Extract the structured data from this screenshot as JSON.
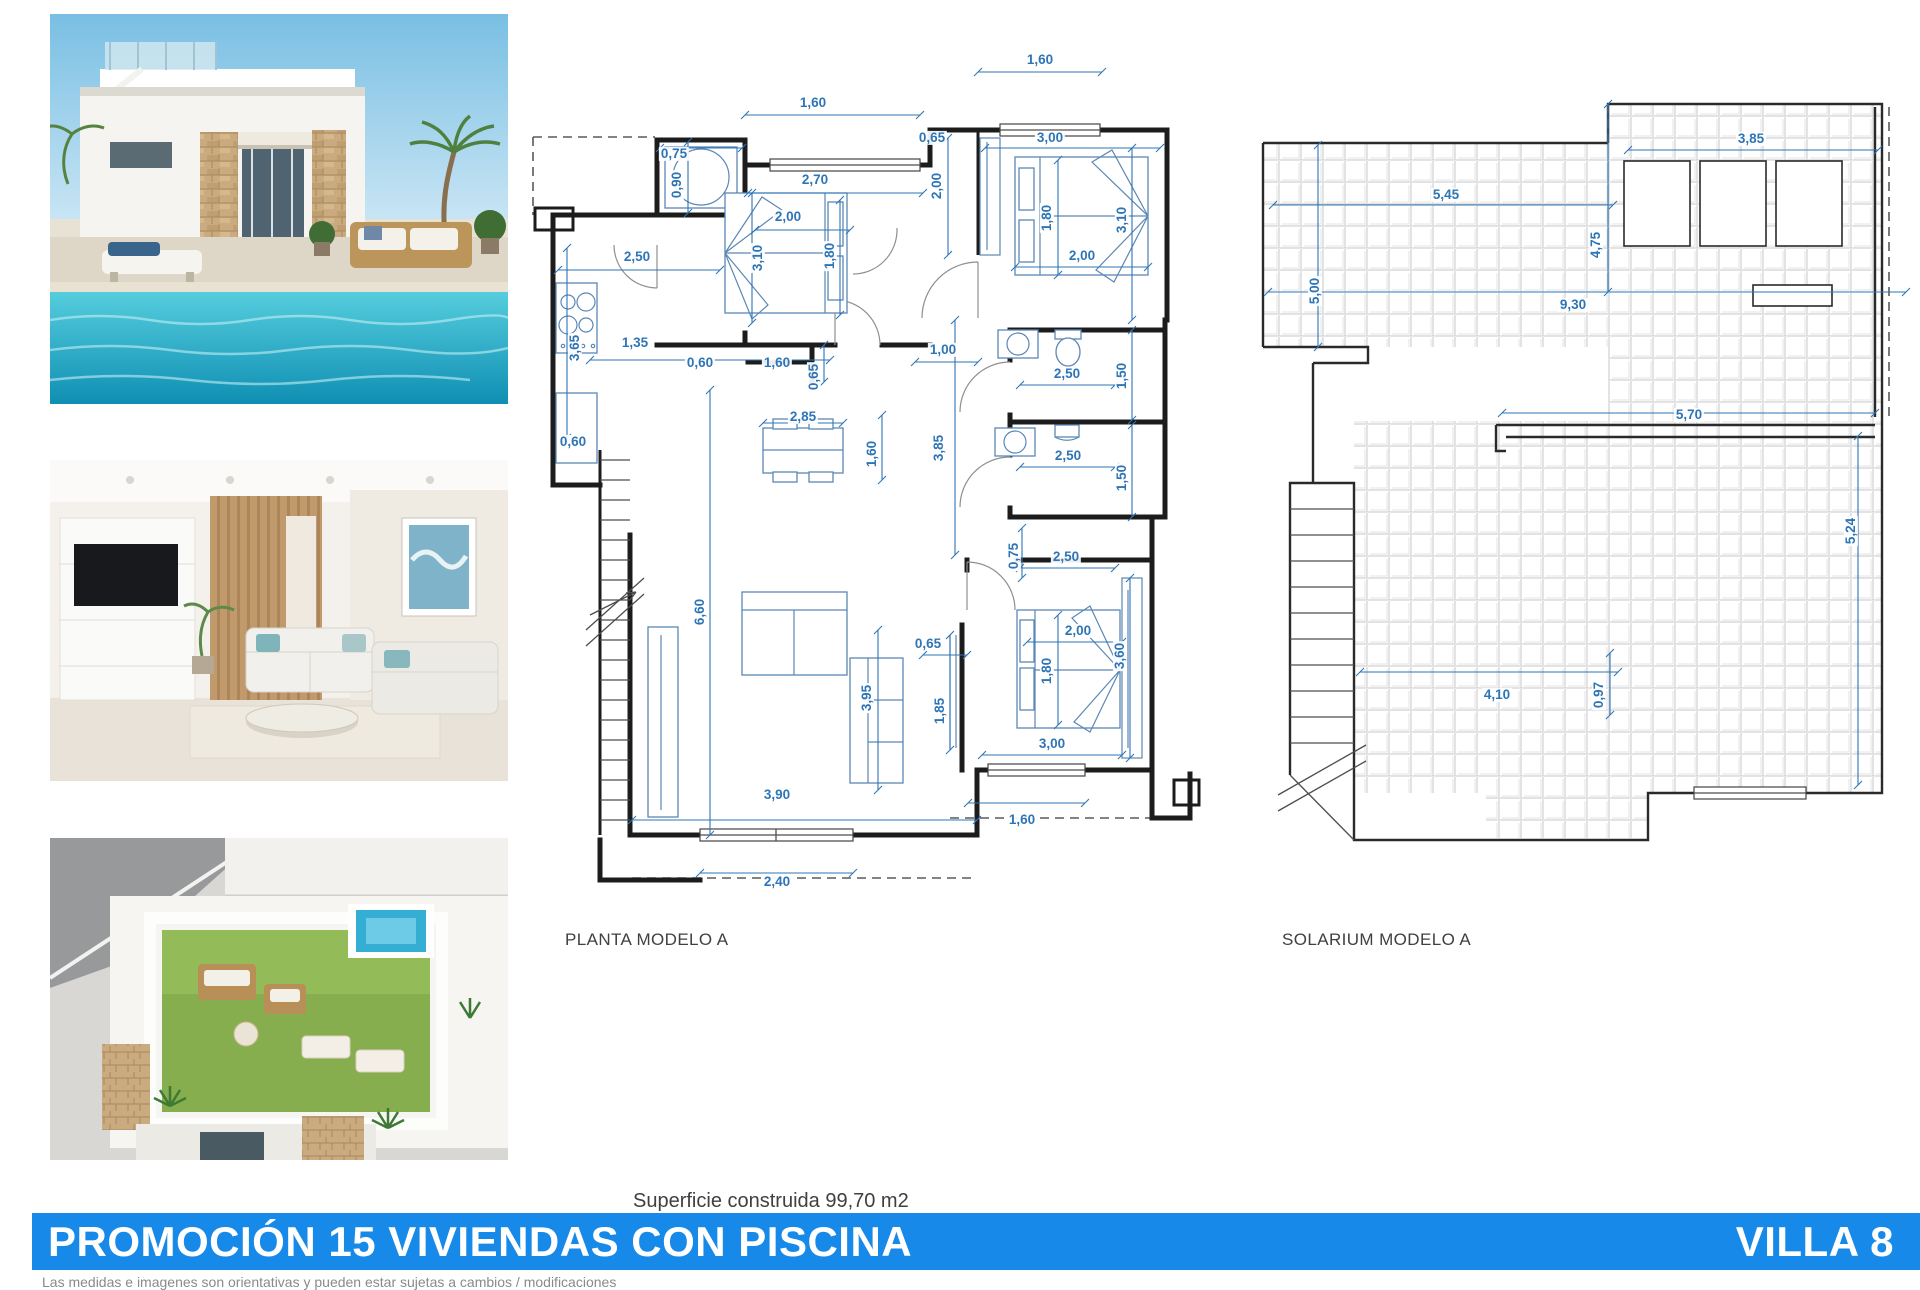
{
  "colors": {
    "dimension": "#2e75b6",
    "bar": "#1789e9",
    "wall": "#1c1c1c"
  },
  "planta": {
    "caption": "PLANTA MODELO A",
    "dims": [
      {
        "t": "1,60",
        "x": 283,
        "y": 73
      },
      {
        "t": "0,75",
        "x": 144,
        "y": 124
      },
      {
        "t": "0,90",
        "x": 147,
        "y": 155,
        "v": 1
      },
      {
        "t": "2,70",
        "x": 285,
        "y": 150
      },
      {
        "t": "2,00",
        "x": 258,
        "y": 187
      },
      {
        "t": "3,10",
        "x": 228,
        "y": 228,
        "v": 1
      },
      {
        "t": "1,80",
        "x": 300,
        "y": 226,
        "v": 1
      },
      {
        "t": "2,50",
        "x": 107,
        "y": 227
      },
      {
        "t": "3,65",
        "x": 45,
        "y": 318,
        "v": 1
      },
      {
        "t": "1,35",
        "x": 105,
        "y": 313
      },
      {
        "t": "0,60",
        "x": 170,
        "y": 333
      },
      {
        "t": "1,60",
        "x": 247,
        "y": 333
      },
      {
        "t": "0,65",
        "x": 284,
        "y": 347,
        "v": 1
      },
      {
        "t": "0,60",
        "x": 43,
        "y": 412
      },
      {
        "t": "1,60",
        "x": 510,
        "y": 30
      },
      {
        "t": "0,65",
        "x": 402,
        "y": 108
      },
      {
        "t": "3,00",
        "x": 520,
        "y": 108
      },
      {
        "t": "2,00",
        "x": 407,
        "y": 156,
        "v": 1
      },
      {
        "t": "1,80",
        "x": 517,
        "y": 188,
        "v": 1
      },
      {
        "t": "3,10",
        "x": 592,
        "y": 190,
        "v": 1
      },
      {
        "t": "2,00",
        "x": 552,
        "y": 226
      },
      {
        "t": "1,00",
        "x": 413,
        "y": 320
      },
      {
        "t": "2,50",
        "x": 537,
        "y": 344
      },
      {
        "t": "1,50",
        "x": 592,
        "y": 346,
        "v": 1
      },
      {
        "t": "2,50",
        "x": 538,
        "y": 426
      },
      {
        "t": "1,50",
        "x": 592,
        "y": 448,
        "v": 1
      },
      {
        "t": "2,85",
        "x": 273,
        "y": 387
      },
      {
        "t": "1,60",
        "x": 342,
        "y": 424,
        "v": 1
      },
      {
        "t": "3,85",
        "x": 409,
        "y": 418,
        "v": 1
      },
      {
        "t": "0,75",
        "x": 484,
        "y": 526,
        "v": 1
      },
      {
        "t": "2,50",
        "x": 536,
        "y": 527
      },
      {
        "t": "6,60",
        "x": 170,
        "y": 582,
        "v": 1
      },
      {
        "t": "3,95",
        "x": 337,
        "y": 668,
        "v": 1
      },
      {
        "t": "0,65",
        "x": 398,
        "y": 614
      },
      {
        "t": "1,85",
        "x": 410,
        "y": 681,
        "v": 1
      },
      {
        "t": "2,00",
        "x": 548,
        "y": 601
      },
      {
        "t": "1,80",
        "x": 517,
        "y": 641,
        "v": 1
      },
      {
        "t": "3,60",
        "x": 590,
        "y": 626,
        "v": 1
      },
      {
        "t": "3,00",
        "x": 522,
        "y": 714
      },
      {
        "t": "1,60",
        "x": 492,
        "y": 790
      },
      {
        "t": "3,90",
        "x": 247,
        "y": 765
      },
      {
        "t": "2,40",
        "x": 247,
        "y": 852
      }
    ]
  },
  "solarium": {
    "caption": "SOLARIUM MODELO A",
    "dims": [
      {
        "t": "3,85",
        "x": 493,
        "y": 44
      },
      {
        "t": "5,45",
        "x": 188,
        "y": 100
      },
      {
        "t": "4,75",
        "x": 338,
        "y": 150,
        "v": 1
      },
      {
        "t": "5,00",
        "x": 57,
        "y": 196,
        "v": 1
      },
      {
        "t": "9,30",
        "x": 315,
        "y": 210
      },
      {
        "t": "5,70",
        "x": 431,
        "y": 320
      },
      {
        "t": "5,24",
        "x": 593,
        "y": 436,
        "v": 1
      },
      {
        "t": "4,10",
        "x": 239,
        "y": 600
      },
      {
        "t": "0,97",
        "x": 341,
        "y": 600,
        "v": 1
      }
    ]
  },
  "footer": {
    "superficie": "Superficie construida 99,70 m2",
    "promo": "PROMOCIÓN 15 VIVIENDAS CON PISCINA",
    "villa": "VILLA 8",
    "disclaimer": "Las medidas e imagenes son orientativas y pueden estar sujetas a cambios / modificaciones"
  }
}
